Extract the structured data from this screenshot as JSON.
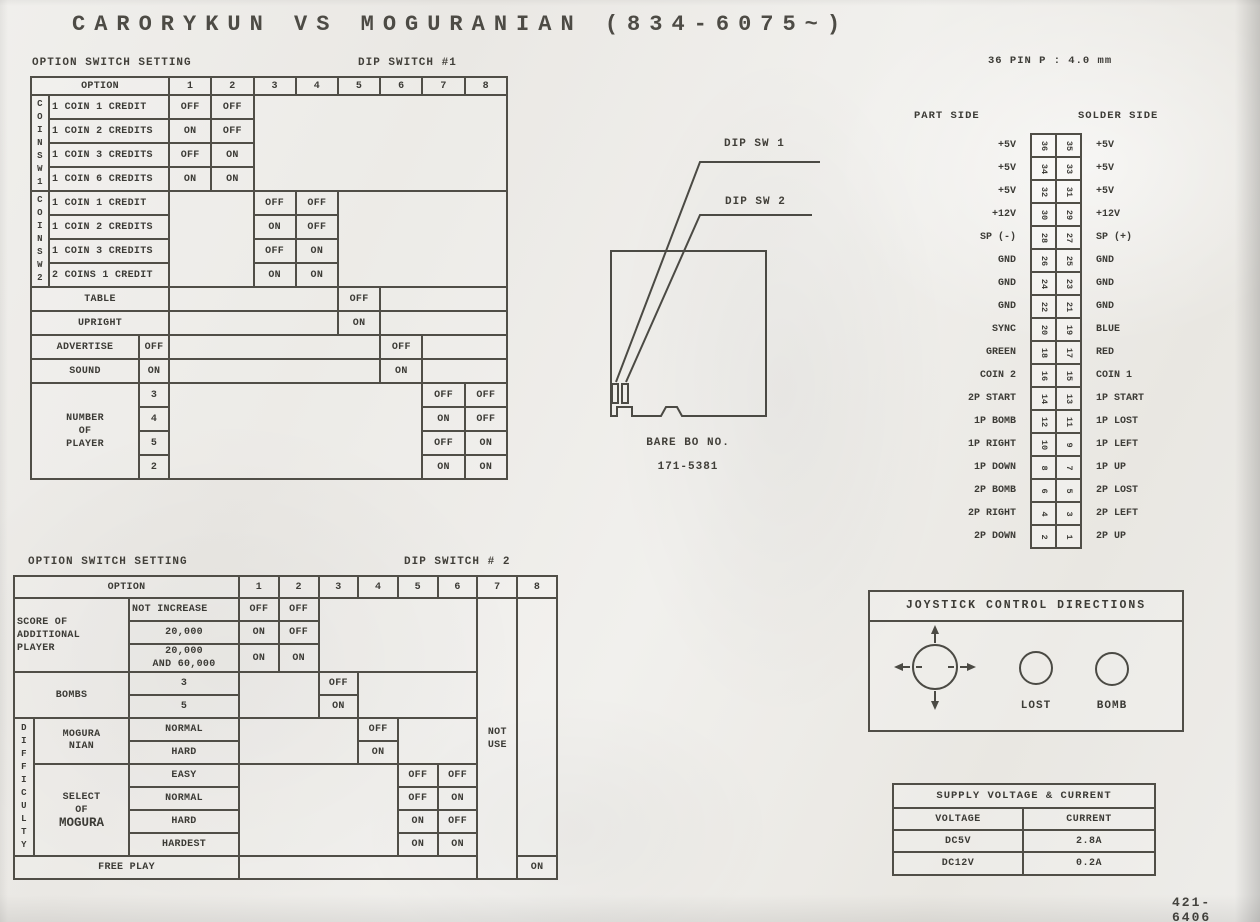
{
  "page": {
    "title": "CARORYKUN VS MOGURANIAN (834-6075~)",
    "doc_number": "421- 6406",
    "colors": {
      "paper": "#edebe7",
      "ink": "#3c3b36",
      "line": "#504e47"
    }
  },
  "dip1": {
    "caption": "OPTION SWITCH SETTING",
    "switch_label": "DIP SWITCH #1",
    "header": {
      "option": "OPTION",
      "cols": [
        "1",
        "2",
        "3",
        "4",
        "5",
        "6",
        "7",
        "8"
      ]
    },
    "coin_sw1": {
      "label": "COINSW1",
      "rows": [
        {
          "name": "1 COIN 1 CREDIT",
          "a": "OFF",
          "b": "OFF"
        },
        {
          "name": "1 COIN 2 CREDITS",
          "a": "ON",
          "b": "OFF"
        },
        {
          "name": "1 COIN 3 CREDITS",
          "a": "OFF",
          "b": "ON"
        },
        {
          "name": "1 COIN 6 CREDITS",
          "a": "ON",
          "b": "ON"
        }
      ]
    },
    "coin_sw2": {
      "label": "COINSW2",
      "rows": [
        {
          "name": "1 COIN 1 CREDIT",
          "a": "OFF",
          "b": "OFF"
        },
        {
          "name": "1 COIN 2 CREDITS",
          "a": "ON",
          "b": "OFF"
        },
        {
          "name": "1 COIN 3 CREDITS",
          "a": "OFF",
          "b": "ON"
        },
        {
          "name": "2 COINS 1 CREDIT",
          "a": "ON",
          "b": "ON"
        }
      ]
    },
    "cabinet": {
      "rows": [
        {
          "name": "TABLE",
          "v": "OFF"
        },
        {
          "name": "UPRIGHT",
          "v": "ON"
        }
      ]
    },
    "advertise": {
      "rows": [
        {
          "name": "ADVERTISE",
          "sub": "OFF",
          "v": "OFF"
        },
        {
          "name": "SOUND",
          "sub": "ON",
          "v": "ON"
        }
      ]
    },
    "players": {
      "name": "NUMBER\nOF\nPLAYER",
      "rows": [
        {
          "sub": "3",
          "a": "OFF",
          "b": "OFF"
        },
        {
          "sub": "4",
          "a": "ON",
          "b": "OFF"
        },
        {
          "sub": "5",
          "a": "OFF",
          "b": "ON"
        },
        {
          "sub": "2",
          "a": "ON",
          "b": "ON"
        }
      ]
    }
  },
  "dip2": {
    "caption": "OPTION SWITCH SETTING",
    "switch_label": "DIP SWITCH # 2",
    "header": {
      "option": "OPTION",
      "cols": [
        "1",
        "2",
        "3",
        "4",
        "5",
        "6",
        "7",
        "8"
      ]
    },
    "score": {
      "name": "SCORE OF\nADDITIONAL\nPLAYER",
      "rows": [
        {
          "sub": "NOT INCREASE",
          "a": "OFF",
          "b": "OFF"
        },
        {
          "sub": "20,000",
          "a": "ON",
          "b": "OFF"
        },
        {
          "sub": "20,000\nAND 60,000",
          "a": "ON",
          "b": "ON"
        }
      ]
    },
    "bombs": {
      "name": "BOMBS",
      "rows": [
        {
          "sub": "3",
          "v": "OFF"
        },
        {
          "sub": "5",
          "v": "ON"
        }
      ]
    },
    "difficulty_label": "DIFFICULTY",
    "moguranian": {
      "name": "MOGURA\nNIAN",
      "rows": [
        {
          "sub": "NORMAL",
          "v": "OFF"
        },
        {
          "sub": "HARD",
          "v": "ON"
        }
      ]
    },
    "mogura_select": {
      "name_top": "SELECT\nOF",
      "name_main": "MOGURA",
      "rows": [
        {
          "sub": "EASY",
          "a": "OFF",
          "b": "OFF"
        },
        {
          "sub": "NORMAL",
          "a": "OFF",
          "b": "ON"
        },
        {
          "sub": "HARD",
          "a": "ON",
          "b": "OFF"
        },
        {
          "sub": "HARDEST",
          "a": "ON",
          "b": "ON"
        }
      ]
    },
    "not_use": "NOT\nUSE",
    "free_play": {
      "name": "FREE PLAY",
      "v": "ON"
    }
  },
  "pcb": {
    "sw1_label": "DIP SW 1",
    "sw2_label": "DIP SW 2",
    "board_no": "BARE BO NO.\n171-5381"
  },
  "connector": {
    "title": "36 PIN   P : 4.0 mm",
    "part_side": "PART SIDE",
    "solder_side": "SOLDER SIDE",
    "pins": [
      {
        "left": "+5V",
        "ln": "36",
        "rn": "35",
        "right": "+5V"
      },
      {
        "left": "+5V",
        "ln": "34",
        "rn": "33",
        "right": "+5V"
      },
      {
        "left": "+5V",
        "ln": "32",
        "rn": "31",
        "right": "+5V"
      },
      {
        "left": "+12V",
        "ln": "30",
        "rn": "29",
        "right": "+12V"
      },
      {
        "left": "SP (-)",
        "ln": "28",
        "rn": "27",
        "right": "SP (+)"
      },
      {
        "left": "GND",
        "ln": "26",
        "rn": "25",
        "right": "GND"
      },
      {
        "left": "GND",
        "ln": "24",
        "rn": "23",
        "right": "GND"
      },
      {
        "left": "GND",
        "ln": "22",
        "rn": "21",
        "right": "GND"
      },
      {
        "left": "SYNC",
        "ln": "20",
        "rn": "19",
        "right": "BLUE"
      },
      {
        "left": "GREEN",
        "ln": "18",
        "rn": "17",
        "right": "RED"
      },
      {
        "left": "COIN 2",
        "ln": "16",
        "rn": "15",
        "right": "COIN 1"
      },
      {
        "left": "2P START",
        "ln": "14",
        "rn": "13",
        "right": "1P START"
      },
      {
        "left": "1P BOMB",
        "ln": "12",
        "rn": "11",
        "right": "1P LOST"
      },
      {
        "left": "1P RIGHT",
        "ln": "10",
        "rn": "9",
        "right": "1P LEFT"
      },
      {
        "left": "1P DOWN",
        "ln": "8",
        "rn": "7",
        "right": "1P UP"
      },
      {
        "left": "2P BOMB",
        "ln": "6",
        "rn": "5",
        "right": "2P LOST"
      },
      {
        "left": "2P RIGHT",
        "ln": "4",
        "rn": "3",
        "right": "2P LEFT"
      },
      {
        "left": "2P DOWN",
        "ln": "2",
        "rn": "1",
        "right": "2P UP"
      }
    ]
  },
  "joystick": {
    "title": "JOYSTICK CONTROL DIRECTIONS",
    "button_labels": [
      "LOST",
      "BOMB"
    ]
  },
  "power": {
    "title": "SUPPLY VOLTAGE & CURRENT",
    "headers": [
      "VOLTAGE",
      "CURRENT"
    ],
    "rows": [
      [
        "DC5V",
        "2.8A"
      ],
      [
        "DC12V",
        "0.2A"
      ]
    ]
  }
}
